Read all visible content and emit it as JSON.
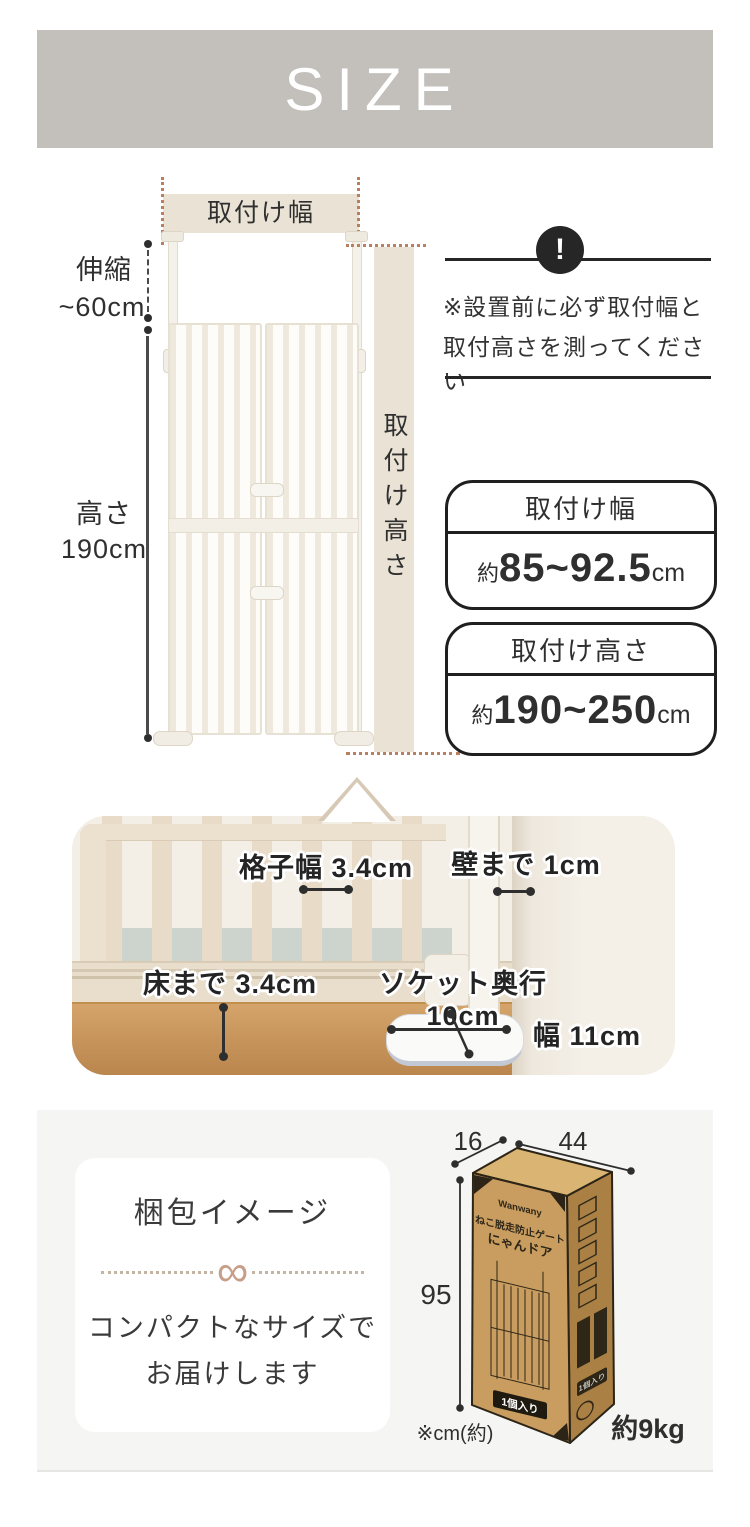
{
  "header": {
    "title": "SIZE"
  },
  "diagram": {
    "mount_width_band": "取付け幅",
    "extension": {
      "line1": "伸縮",
      "line2": "~60cm"
    },
    "height": {
      "line1": "高さ",
      "line2": "190cm"
    },
    "mount_height_band": "取付け高さ",
    "notice": {
      "icon": "!",
      "line1": "※設置前に必ず取付幅と",
      "line2": "取付高さを測ってください"
    },
    "spec_boxes": [
      {
        "title": "取付け幅",
        "approx": "約",
        "value": "85~92.5",
        "unit": "cm"
      },
      {
        "title": "取付け高さ",
        "approx": "約",
        "value": "190~250",
        "unit": "cm"
      }
    ]
  },
  "photo": {
    "annotations": {
      "lattice_width": "格子幅 3.4cm",
      "wall_gap": "壁まで 1cm",
      "floor_gap": "床まで 3.4cm",
      "socket_depth": "ソケット奥行 10cm",
      "socket_width": "幅 11cm"
    }
  },
  "packaging": {
    "card": {
      "title": "梱包イメージ",
      "divider_symbol": "∞",
      "line1": "コンパクトなサイズで",
      "line2": "お届けします"
    },
    "box": {
      "depth": "16",
      "width": "44",
      "height": "95",
      "unit_note": "※cm(約)",
      "weight": "約9kg",
      "front": {
        "brand": "Wanwany",
        "product_line1": "ねこ脱走防止ゲート",
        "product_line2": "にゃんドア",
        "count_badge": "1個入り"
      },
      "side": {
        "count_badge": "1個入り"
      }
    }
  },
  "colors": {
    "header_bg": "#c3c0bb",
    "tan": "#eae3d5",
    "dotted_accent": "#b97f5f",
    "ink": "#2f2f2f",
    "section_bg": "#f5f5f3",
    "cardboard": "#c99c60",
    "cardboard_side": "#aa8045",
    "cardboard_top": "#d9b473",
    "wood_floor": "#c79a67",
    "divider_accent": "#c79e87"
  }
}
